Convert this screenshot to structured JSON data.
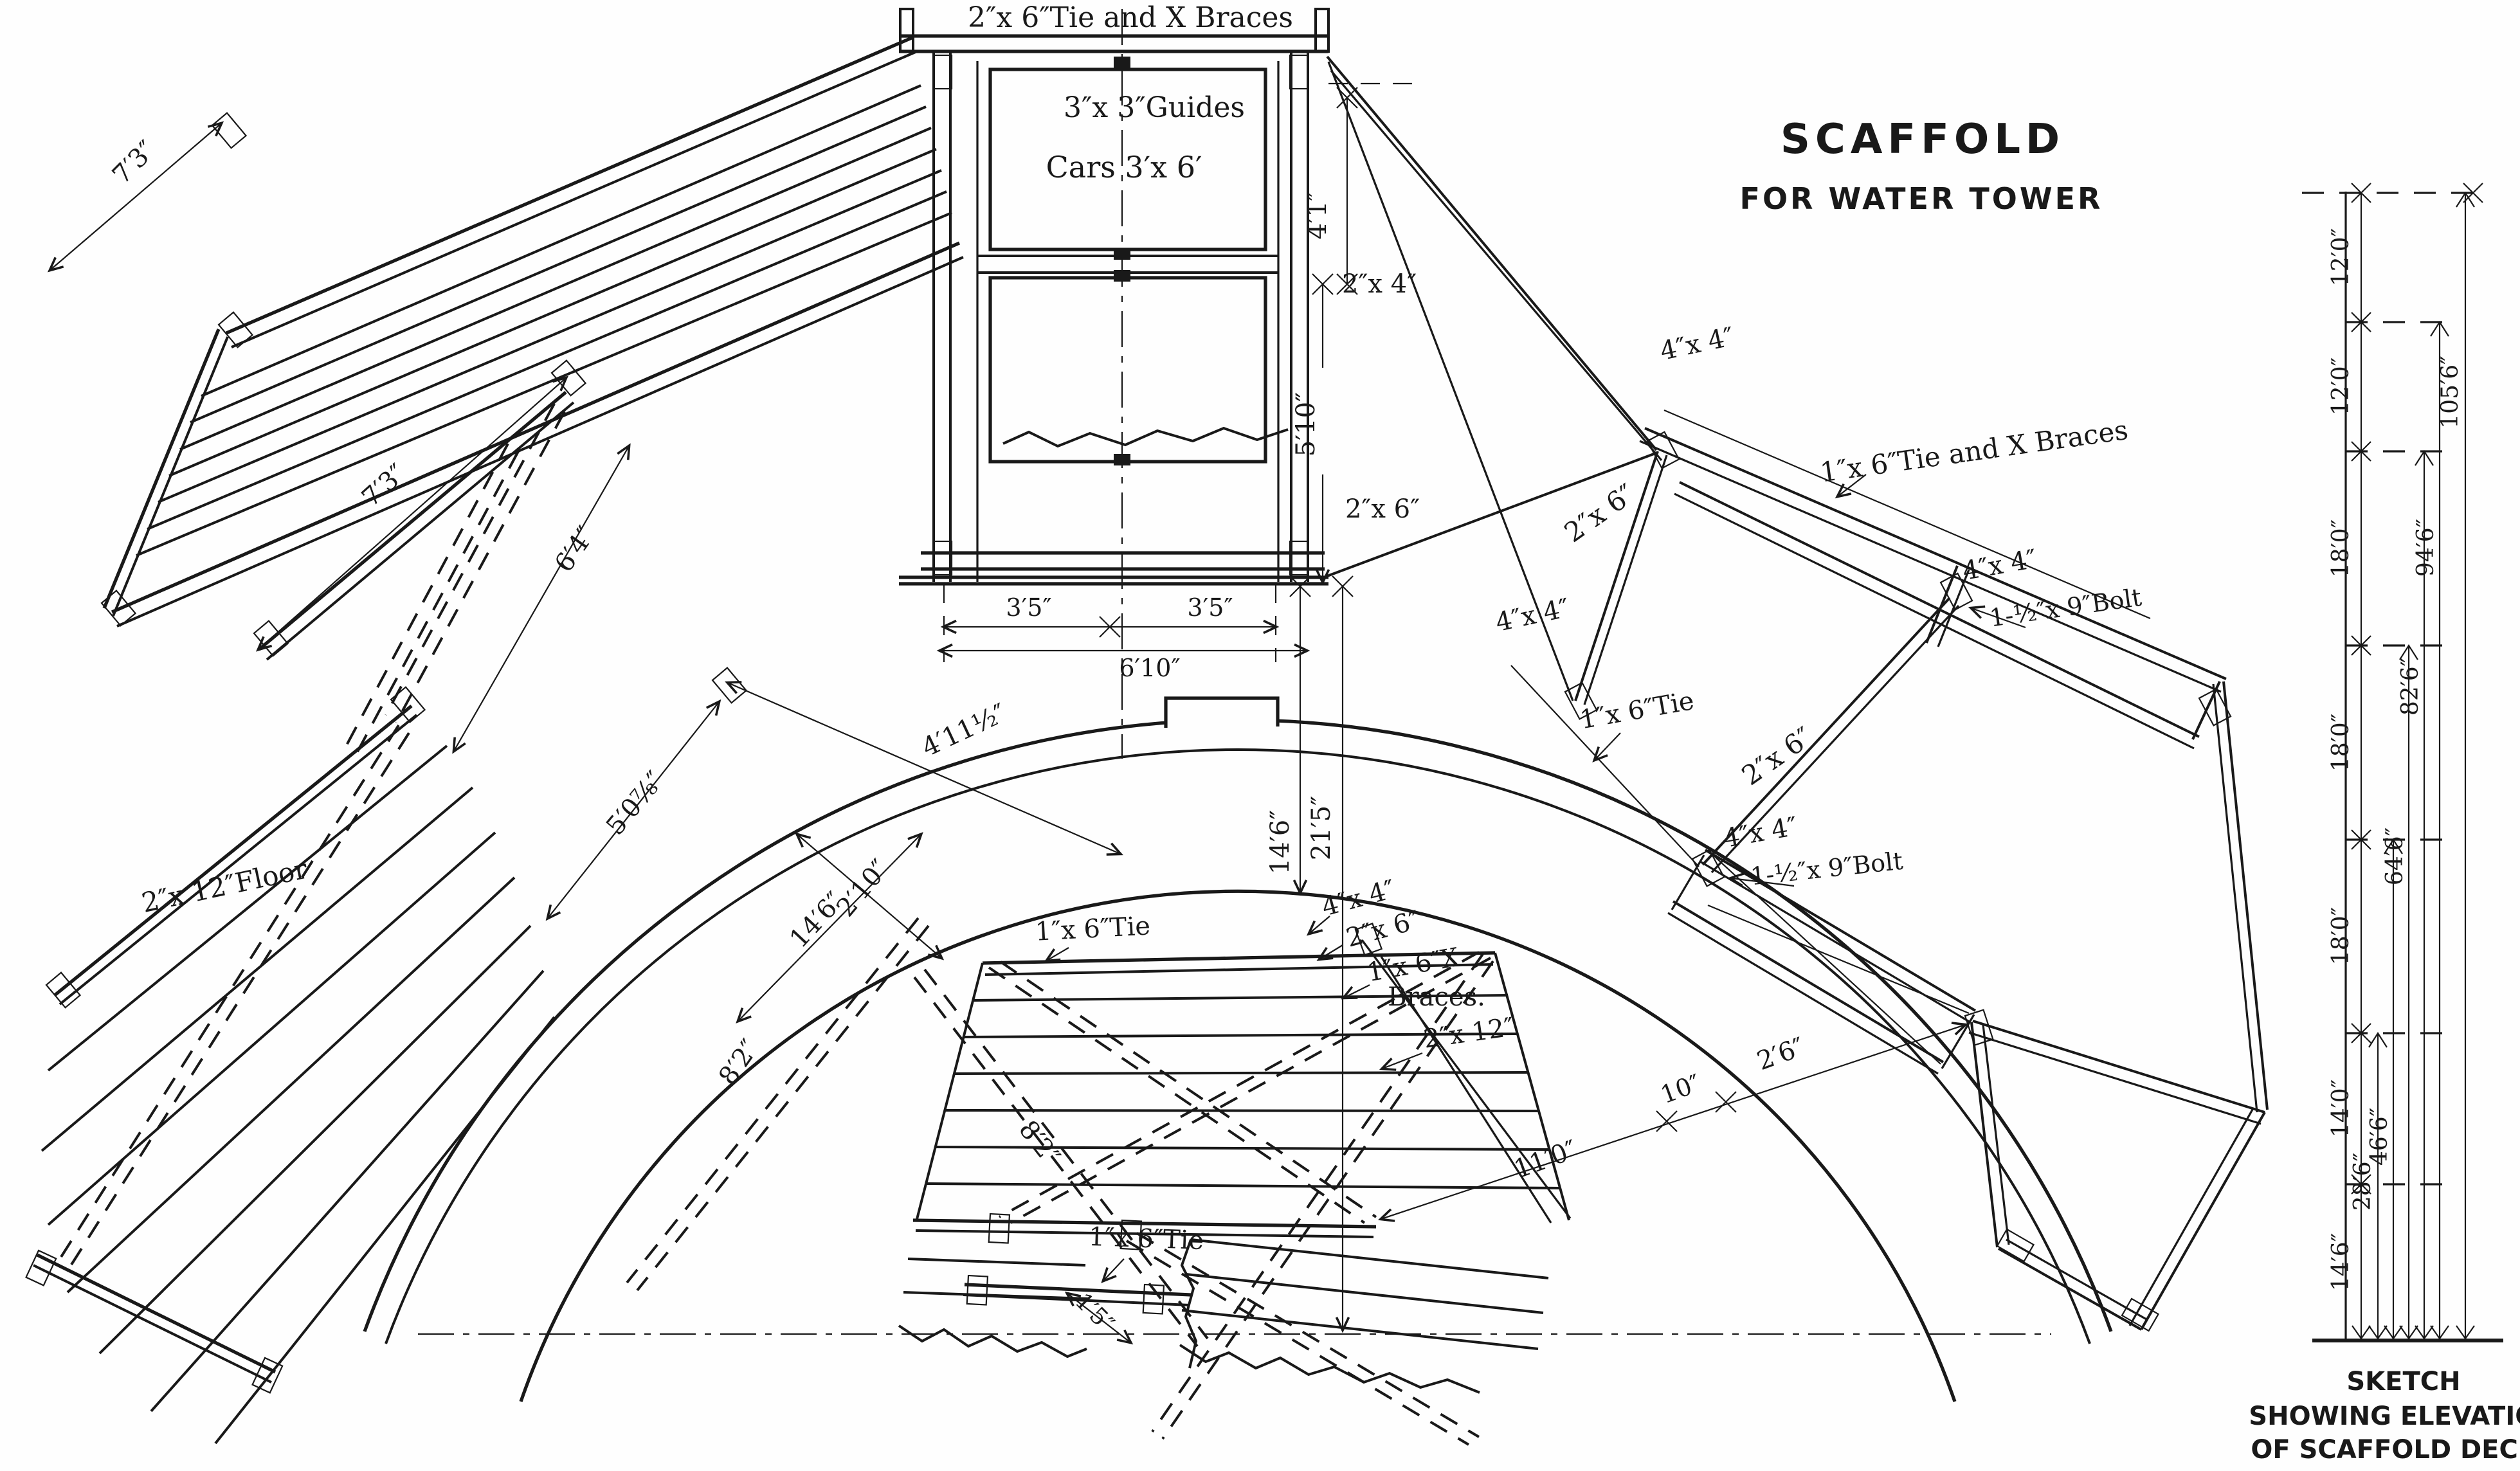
{
  "title": {
    "line1": "SCAFFOLD",
    "line2": "FOR WATER TOWER"
  },
  "caption": {
    "line1": "SKETCH",
    "line2": "SHOWING ELEVATION",
    "line3": "OF SCAFFOLD DECKS"
  },
  "labels": {
    "shaft_tie": "2″x 6″Tie and X Braces",
    "guides": "3″x 3″Guides",
    "cars": "Cars 3′x 6′",
    "dim_4_1": "4′1″",
    "dim_2x4": "2″x 4″",
    "dim_5_10": "5′10″",
    "dim_2x6_shaft": "2″x 6″",
    "dim_3_5_left": "3′5″",
    "dim_6_10": "6′10″",
    "dim_3_5_right": "3′5″",
    "dim_7_3_outer": "7′3″",
    "dim_7_3": "7′3″",
    "dim_6_4": "6′4″",
    "dim_4_11": "4′11½″",
    "dim_5_0": "5′0⅞″",
    "floor_2x12": "2″x 12″Floor",
    "dim_14_6_diag": "14′6″",
    "dim_2_10": "2′10″",
    "tie_mid": "1″x 6″Tie",
    "dim_14_6_v": "14′6″",
    "dim_21_5": "21′5″",
    "mid_4x4": "4″x 4″",
    "mid_2x6": "2″x 6″",
    "mid_x1": "1″x 6″X",
    "mid_x2": "Braces.",
    "mid_2x12": "2″x 12″",
    "dim_8_2_l": "8′2″",
    "dim_8_2_r": "8′2″",
    "tie_bottom": "1″x 6″Tie",
    "dim_1_5": "1′5″",
    "dim_11_0": "11′0″",
    "dim_10": "10″",
    "dim_2_6": "2′6″",
    "r_4x4_top": "4″x 4″",
    "r_tie_braces": "1″x 6″Tie and X Braces",
    "r_2x6_top": "2″x 6″",
    "r_4x4_left": "4″x 4″",
    "r_4x4_right": "4″x 4″",
    "r_bolt_top": "1-½″x 9″Bolt",
    "r_tie": "1″x 6″Tie",
    "r_2x6_low": "2″x 6″",
    "r_4x4_low": "4″x 4″",
    "r_bolt_low": "1-½″x 9″Bolt"
  },
  "elevation": {
    "segments": [
      "12′0″",
      "12′0″",
      "18′0″",
      "18′0″",
      "18′0″",
      "14′0″",
      "14′6″"
    ],
    "cumulative": [
      "28′6″",
      "46′6″",
      "64′6″",
      "82′6″",
      "94′6″",
      "105′6″"
    ]
  },
  "colors": {
    "ink": "#191919",
    "paper": "#fefefe"
  }
}
